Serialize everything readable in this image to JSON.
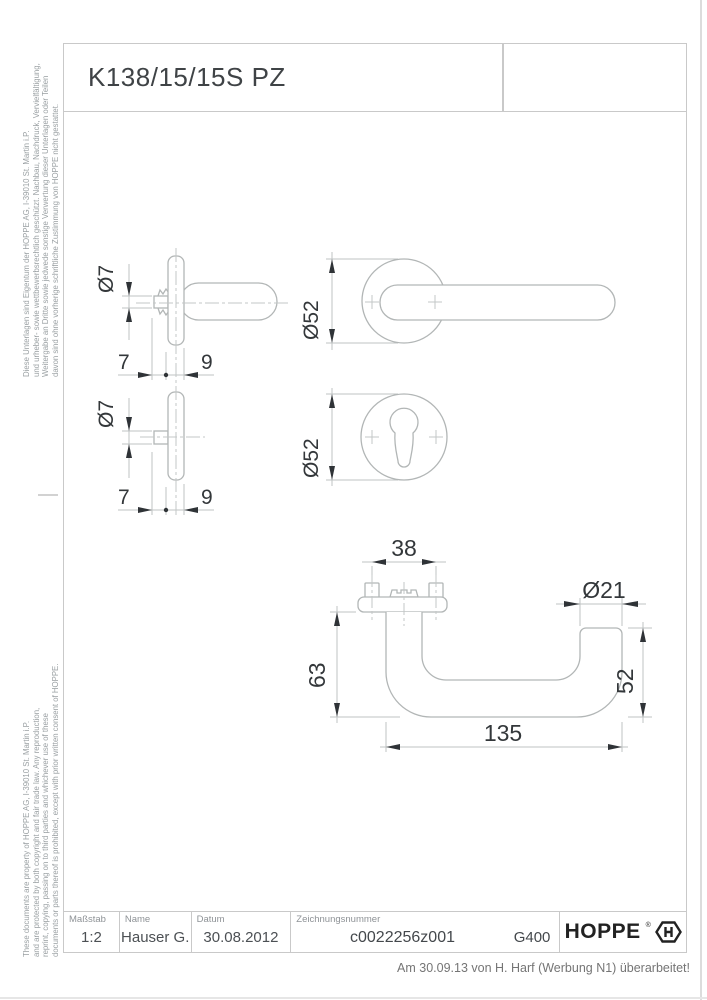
{
  "sheet": {
    "product_code": "K138/15/15S PZ"
  },
  "legal": {
    "german": [
      "Diese Unterlagen sind Eigentum der HOPPE AG, I-39010 St. Martin i.P.",
      "und urheber- sowie wettbewerbsrechtlich geschützt. Nachbau, Nachdruck, Vervielfältigung,",
      "Weitergabe an Dritte sowie jedwede sonstige Verwertung dieser Unterlagen oder Teilen",
      "davon sind ohne vorherige schriftliche Zustimmung von HOPPE nicht gestattet."
    ],
    "english": [
      "These documents are property of HOPPE AG, I-39010 St. Martin i.P.",
      "and are protected by both copyright and fair trade law. Any reproduction,",
      "reprint, copying, passing on to third parties and whichever use of these",
      "documents or parts thereof is prohibited, except with prior written consent of HOPPE."
    ]
  },
  "drawing": {
    "dims": {
      "d7": "Ø7",
      "seven": "7",
      "nine": "9",
      "d52": "Ø52",
      "thirty_eight": "38",
      "d21": "Ø21",
      "sixty_three": "63",
      "fifty_two": "52",
      "one_three_five": "135"
    }
  },
  "title_block": {
    "scale_label": "Maßstab",
    "scale_value": "1:2",
    "name_label": "Name",
    "name_value": "Hauser G.",
    "date_label": "Datum",
    "date_value": "30.08.2012",
    "number_label": "Zeichnungsnummer",
    "number_value": "c0022256z001",
    "finish_code": "G400",
    "brand": "HOPPE",
    "brand_reg": "®"
  },
  "footer": {
    "revision_note": "Am 30.09.13 von H. Harf (Werbung N1) überarbeitet!"
  },
  "colors": {
    "line": "#b6baba",
    "centerline": "#c3c7c7",
    "dimension": "#33373a",
    "frame": "#c9c9c9"
  }
}
